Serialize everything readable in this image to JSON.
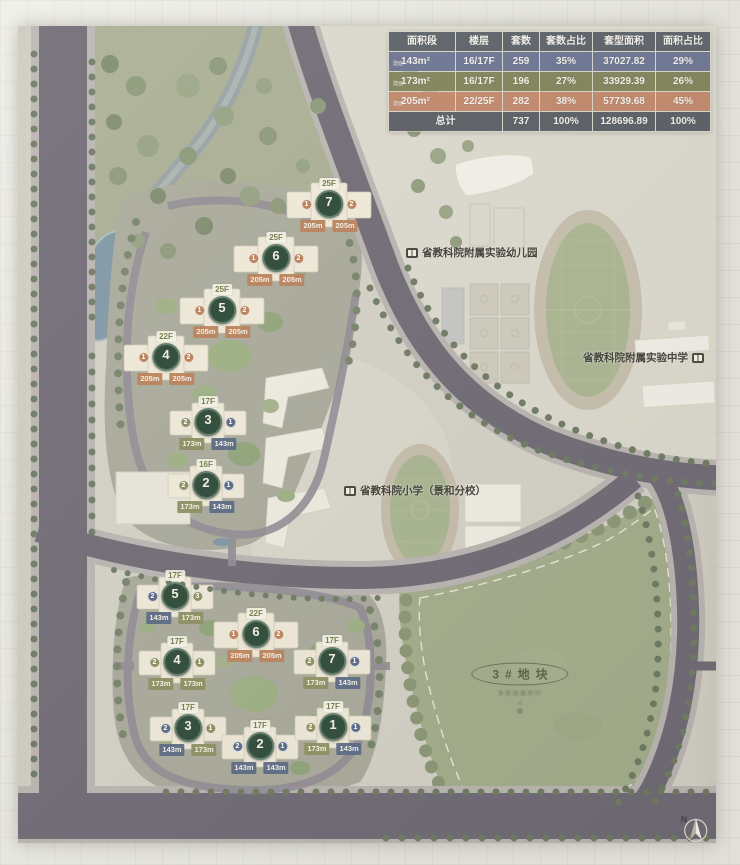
{
  "table": {
    "headers": [
      "面积段",
      "楼层",
      "套数",
      "套数占比",
      "套型面积",
      "面积占比"
    ],
    "rows": [
      {
        "prefix": "建面",
        "area": "143m²",
        "floor": "16/17F",
        "count": "259",
        "count_pct": "35%",
        "gfa": "37027.82",
        "gfa_pct": "29%"
      },
      {
        "prefix": "建面",
        "area": "173m²",
        "floor": "16/17F",
        "count": "196",
        "count_pct": "27%",
        "gfa": "33929.39",
        "gfa_pct": "26%"
      },
      {
        "prefix": "建面",
        "area": "205m²",
        "floor": "22/25F",
        "count": "282",
        "count_pct": "38%",
        "gfa": "57739.68",
        "gfa_pct": "45%"
      }
    ],
    "total": {
      "label": "总计",
      "count": "737",
      "count_pct": "100%",
      "gfa": "128696.89",
      "gfa_pct": "100%"
    }
  },
  "labels": {
    "kindergarten": "省教科院附属实验幼儿园",
    "middle_school": "省教科院附属实验中学",
    "primary_school": "省教科院小学（景和分校）",
    "plot": "3#地块",
    "plot_note1": "净用地面积约",
    "plot_note2": "㎡",
    "north": "N"
  },
  "colors": {
    "type_143": "#5e6c86",
    "type_173": "#8e9164",
    "type_205": "#bc8560",
    "road": "#6e6973",
    "green": "#a3ad8a"
  },
  "buildings": {
    "upper": [
      {
        "num": "7",
        "floor": "25F",
        "unit_left": "1",
        "unit_right": "2",
        "area_left": "205m",
        "area_right": "205m"
      },
      {
        "num": "6",
        "floor": "25F",
        "unit_left": "1",
        "unit_right": "2",
        "area_left": "205m",
        "area_right": "205m"
      },
      {
        "num": "5",
        "floor": "25F",
        "unit_left": "1",
        "unit_right": "2",
        "area_left": "205m",
        "area_right": "205m"
      },
      {
        "num": "4",
        "floor": "22F",
        "unit_left": "1",
        "unit_right": "2",
        "area_left": "205m",
        "area_right": "205m"
      },
      {
        "num": "3",
        "floor": "17F",
        "unit_left": "2",
        "unit_right": "1",
        "area_left": "173m",
        "area_right": "143m"
      },
      {
        "num": "2",
        "floor": "16F",
        "unit_left": "2",
        "unit_right": "1",
        "area_left": "173m",
        "area_right": "143m"
      }
    ],
    "lower": [
      {
        "num": "5",
        "floor": "17F",
        "unit_left": "2",
        "unit_right": "3",
        "area_left": "143m",
        "area_right": "173m"
      },
      {
        "num": "6",
        "floor": "22F",
        "unit_left": "1",
        "unit_right": "2",
        "area_left": "205m",
        "area_right": "205m"
      },
      {
        "num": "4",
        "floor": "17F",
        "unit_left": "2",
        "unit_right": "1",
        "area_left": "173m",
        "area_right": "173m"
      },
      {
        "num": "7",
        "floor": "17F",
        "unit_left": "2",
        "unit_right": "1",
        "area_left": "173m",
        "area_right": "143m"
      },
      {
        "num": "3",
        "floor": "17F",
        "unit_left": "2",
        "unit_right": "1",
        "area_left": "143m",
        "area_right": "173m"
      },
      {
        "num": "2",
        "floor": "17F",
        "unit_left": "2",
        "unit_right": "1",
        "area_left": "143m",
        "area_right": "143m"
      },
      {
        "num": "1",
        "floor": "17F",
        "unit_left": "2",
        "unit_right": "1",
        "area_left": "173m",
        "area_right": "143m"
      }
    ]
  }
}
